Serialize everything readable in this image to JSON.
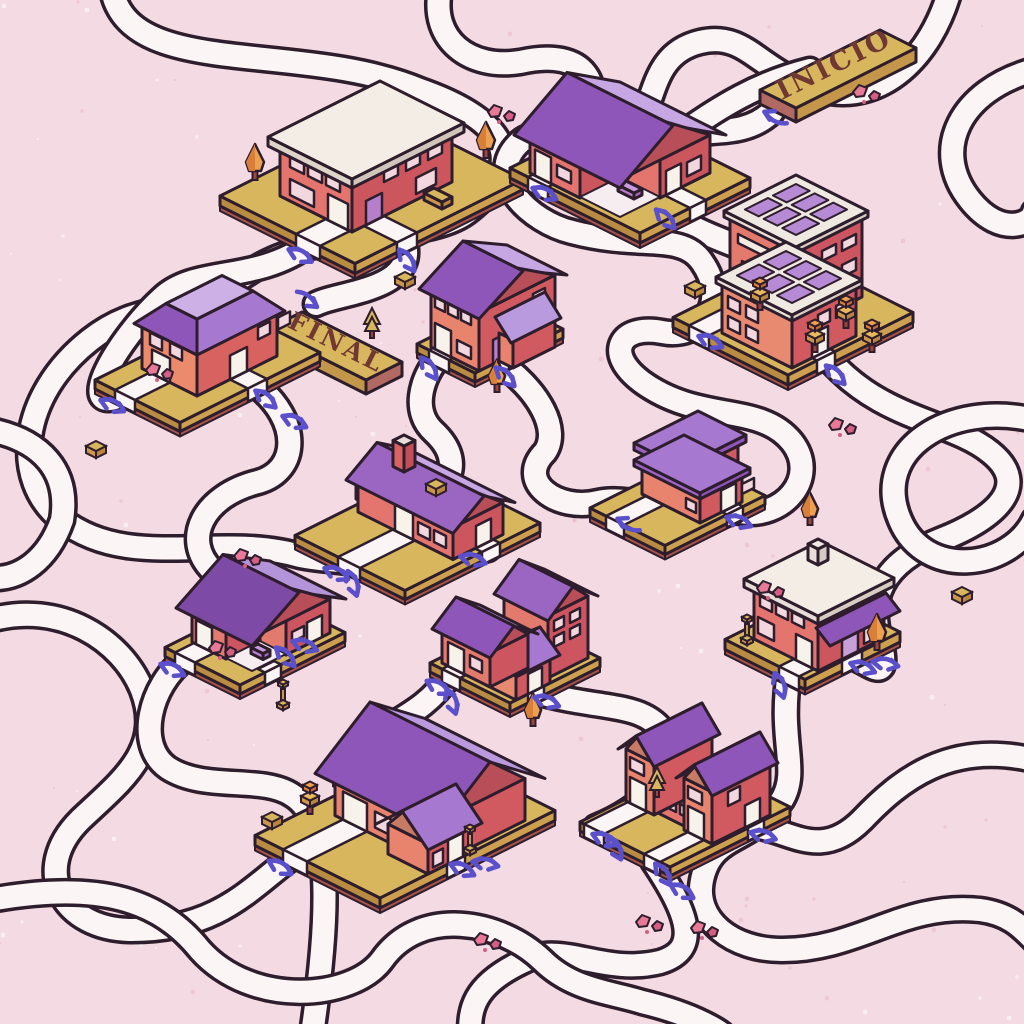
{
  "title": "Road maze illustration with isometric houses",
  "signs": {
    "start": {
      "label": "INICIO"
    },
    "end": {
      "label": "FINAL"
    }
  },
  "palette": {
    "background": "#f4dae2",
    "road": "#fcf5f6",
    "line": "#2e1d2c",
    "plat_top": "#d7b65e",
    "plat_left": "#ba8c42",
    "plat_right": "#cda04f",
    "plat_trim": "#a5554b",
    "wall_salmon": "#e4756e",
    "wall_red": "#cc565e",
    "roof_dark": "#8e56b8",
    "roof_mid": "#a678cf",
    "roof_light": "#c7a6e4",
    "roof_white": "#f3ede5",
    "door": "#f7f2ea",
    "door_purple": "#b57fc9",
    "win": "#f2d8de",
    "panel": "#b78ad6",
    "arrow": "#5b50cc",
    "rock": "#e87a98",
    "sign_gold": "#d7b65e",
    "sign_text": "#6f3833"
  },
  "scene": {
    "roads": [
      "M112,-10 C130,80 300,40 420,90 C520,125 520,170 470,210 C430,245 320,225 250,272 C180,318 140,300 90,340 C20,395 10,480 62,520 C130,572 220,532 300,556 C320,560 334,560 346,562",
      "M772,112 C740,142 700,124 660,142 C600,168 560,160 540,180",
      "M659,206 C700,240 770,252 805,278 C845,312 830,345 762,345 C730,342 712,336 701,331",
      "M827,357 C880,420 950,420 990,452 C1034,487 992,520 940,540 C880,564 868,600 880,640 C892,688 868,662 854,658",
      "M950,-10 C930,60 882,100 830,92 C760,78 750,30 700,42 C642,56 660,120 622,142 C565,165 542,122 520,142 C482,177 530,222 572,232 C640,250 682,232 702,262 C730,302 702,340 662,332 C622,324 602,352 642,382 C700,424 760,402 792,442 C820,478 782,520 740,512 C682,498 640,510 617,520",
      "M310,244 C255,284 196,266 162,298 C118,338 70,420 125,394",
      "M404,240 C420,290 340,292 316,304",
      "M257,386 C300,420 300,470 258,482 C202,496 182,540 212,570 C252,610 318,620 276,664",
      "M439,357 C420,380 412,412 434,432 C466,462 448,492 418,502 C390,512 380,542 420,556 C450,564 472,552 488,549",
      "M500,363 C540,392 560,430 545,452 C515,482 558,512 598,502 C640,492 700,530 733,511",
      "M-10,620 C60,600 122,640 142,690 C165,750 120,782 80,820 C30,870 62,930 132,930 C220,930 252,886 294,856",
      "M185,659 C150,685 135,745 168,768 C205,792 262,775 292,795 C330,818 332,900 312,1034",
      "M450,675 C420,720 380,722 360,752 C335,788 360,820 400,820 C432,820 458,836 453,858",
      "M536,692 C600,710 640,702 662,730 C690,768 640,810 596,827",
      "M789,673 C778,740 800,770 782,800 C752,845 712,832 702,880 C694,920 732,950 782,950 C860,950 902,902 980,910 C1010,914 1022,928 1034,940",
      "M653,861 C690,916 700,950 660,962 C602,976 562,940 522,962 C472,986 470,1010 470,1034",
      "M1034,70 C960,90 930,150 970,200 C1002,240 1034,222 1034,212",
      "M1034,420 C950,400 870,450 900,520 C925,580 1010,570 1034,520",
      "M-10,900 C100,880 160,900 200,950 C252,1008 352,1000 382,960 C420,906 500,920 542,960 C572,990 610,992 642,1002 C700,1016 722,1034 722,1034",
      "M-10,430 C40,440 70,470 62,520 C48,560 20,580 -10,578",
      "M440,-10 C430,40 470,70 520,62 C590,46 602,90 586,120 C570,150 602,172 632,162 C682,142 722,92 810,70",
      "M1034,760 C950,740 900,780 862,820 C820,862 790,830 754,826"
    ],
    "arrows": [
      [
        775,
        120,
        205,
        "s"
      ],
      [
        308,
        297,
        35,
        "s"
      ],
      [
        302,
        252,
        28,
        "d"
      ],
      [
        410,
        258,
        55,
        "d"
      ],
      [
        546,
        190,
        25,
        "d"
      ],
      [
        668,
        216,
        45,
        "d"
      ],
      [
        114,
        402,
        25,
        "d"
      ],
      [
        268,
        396,
        40,
        "d"
      ],
      [
        296,
        418,
        25,
        "d"
      ],
      [
        432,
        366,
        55,
        "d"
      ],
      [
        508,
        374,
        45,
        "d"
      ],
      [
        712,
        338,
        25,
        "d"
      ],
      [
        838,
        372,
        45,
        "d"
      ],
      [
        338,
        570,
        25,
        "d"
      ],
      [
        356,
        582,
        70,
        "d"
      ],
      [
        474,
        556,
        15,
        "d"
      ],
      [
        628,
        527,
        205,
        "s"
      ],
      [
        740,
        518,
        20,
        "d"
      ],
      [
        174,
        666,
        25,
        "d"
      ],
      [
        288,
        654,
        45,
        "d"
      ],
      [
        306,
        642,
        20,
        "d"
      ],
      [
        440,
        684,
        30,
        "d"
      ],
      [
        455,
        700,
        70,
        "d"
      ],
      [
        548,
        698,
        20,
        "d"
      ],
      [
        783,
        684,
        70,
        "d"
      ],
      [
        864,
        664,
        20,
        "d"
      ],
      [
        886,
        660,
        10,
        "d"
      ],
      [
        282,
        864,
        30,
        "d"
      ],
      [
        464,
        866,
        25,
        "d"
      ],
      [
        486,
        860,
        10,
        "d"
      ],
      [
        606,
        836,
        25,
        "d"
      ],
      [
        618,
        846,
        60,
        "d"
      ],
      [
        666,
        872,
        55,
        "d"
      ],
      [
        684,
        888,
        30,
        "d"
      ],
      [
        764,
        832,
        15,
        "d"
      ]
    ],
    "buildings": [
      {
        "id": "corner-store",
        "name": "flat roof corner store",
        "type": "shop",
        "x": 388,
        "y": 112
      },
      {
        "id": "porch-house-north",
        "name": "gabled house with porch",
        "type": "gableL",
        "x": 620,
        "y": 113
      },
      {
        "id": "solar-building",
        "name": "offices with solar panels",
        "type": "solar",
        "x": 798,
        "y": 255
      },
      {
        "id": "tall-house",
        "name": "tall two story house",
        "type": "gable2",
        "x": 505,
        "y": 300
      },
      {
        "id": "mansard-house",
        "name": "mansard roof house",
        "type": "mansard",
        "x": 235,
        "y": 310
      },
      {
        "id": "l-shaped-house",
        "name": "L-shaped flat roof house",
        "type": "lshape",
        "x": 690,
        "y": 458
      },
      {
        "id": "long-house",
        "name": "long cottage with chimney",
        "type": "long",
        "x": 430,
        "y": 468
      },
      {
        "id": "awning-house",
        "name": "house with purple awning",
        "type": "awning",
        "x": 820,
        "y": 592
      },
      {
        "id": "porch-house-west",
        "name": "small porch house",
        "type": "porch",
        "x": 270,
        "y": 595
      },
      {
        "id": "cluster-house",
        "name": "three gable cluster house",
        "type": "cluster",
        "x": 520,
        "y": 618
      },
      {
        "id": "grand-house",
        "name": "grand house with tree row",
        "type": "bighouse",
        "x": 430,
        "y": 748
      },
      {
        "id": "twin-gable-house",
        "name": "long house with twin gables",
        "type": "twin",
        "x": 700,
        "y": 762
      }
    ],
    "decorations": [
      {
        "kind": "roundTree",
        "x": 255,
        "y": 180,
        "s": 1
      },
      {
        "kind": "roundTree",
        "x": 486,
        "y": 158,
        "s": 1
      },
      {
        "kind": "roundTree",
        "x": 497,
        "y": 392,
        "s": 0.9
      },
      {
        "kind": "roundTree",
        "x": 810,
        "y": 525,
        "s": 0.9
      },
      {
        "kind": "roundTree",
        "x": 877,
        "y": 650,
        "s": 1
      },
      {
        "kind": "roundTree",
        "x": 533,
        "y": 726,
        "s": 0.9
      },
      {
        "kind": "blockTree",
        "x": 815,
        "y": 352
      },
      {
        "kind": "blockTree",
        "x": 846,
        "y": 328
      },
      {
        "kind": "blockTree",
        "x": 872,
        "y": 352
      },
      {
        "kind": "blockTree",
        "x": 760,
        "y": 310
      },
      {
        "kind": "cube",
        "x": 405,
        "y": 287
      },
      {
        "kind": "cube",
        "x": 436,
        "y": 494
      },
      {
        "kind": "cube",
        "x": 96,
        "y": 456
      },
      {
        "kind": "cube",
        "x": 962,
        "y": 602
      },
      {
        "kind": "cube",
        "x": 272,
        "y": 827
      },
      {
        "kind": "cube",
        "x": 695,
        "y": 296
      },
      {
        "kind": "pine",
        "x": 657,
        "y": 797
      },
      {
        "kind": "lamp",
        "x": 283,
        "y": 707
      },
      {
        "kind": "lamp",
        "x": 747,
        "y": 642
      },
      {
        "kind": "lamp",
        "x": 470,
        "y": 852
      },
      {
        "kind": "rocks",
        "x": 838,
        "y": 425
      },
      {
        "kind": "rocks",
        "x": 243,
        "y": 556
      },
      {
        "kind": "rocks",
        "x": 483,
        "y": 940
      },
      {
        "kind": "rocks",
        "x": 700,
        "y": 928
      },
      {
        "kind": "rocks",
        "x": 497,
        "y": 112
      },
      {
        "kind": "rocks",
        "x": 862,
        "y": 92
      },
      {
        "kind": "rocks",
        "x": 766,
        "y": 588
      },
      {
        "kind": "rocks",
        "x": 645,
        "y": 922
      },
      {
        "kind": "rocks",
        "x": 218,
        "y": 648
      },
      {
        "kind": "rocks",
        "x": 155,
        "y": 370
      }
    ]
  }
}
